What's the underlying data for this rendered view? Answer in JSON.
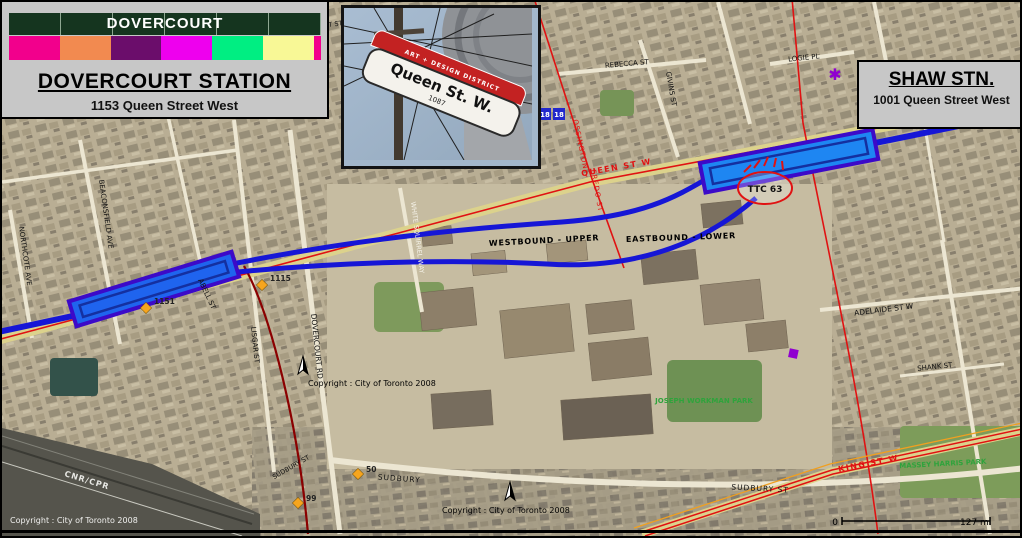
{
  "legend": {
    "title": "DOVERCOURT",
    "colors": [
      "#F2008C",
      "#F28A50",
      "#6B0D6B",
      "#EE00EE",
      "#00EE82",
      "#F8F896"
    ],
    "sliver_color": "#F2008C"
  },
  "panels": {
    "left_station": {
      "title": "DOVERCOURT STATION",
      "subtitle": "1153 Queen Street West"
    },
    "right_station": {
      "title": "SHAW STN.",
      "subtitle": "1001 Queen Street West"
    }
  },
  "inset_photo": {
    "sign_banner": "ART + DESIGN DISTRICT",
    "sign_main": "Queen St. W.",
    "sign_number": "1087"
  },
  "map": {
    "track_labels": [
      {
        "text": "WESTBOUND - UPPER"
      },
      {
        "text": "EASTBOUND - LOWER"
      }
    ],
    "street_labels": [
      {
        "text": "QUEEN ST W"
      },
      {
        "text": "OSSINGTON"
      },
      {
        "text": "FREDO ST"
      },
      {
        "text": "KING ST W"
      },
      {
        "text": "DOVERCOURT RD"
      },
      {
        "text": "LISGAR ST"
      },
      {
        "text": "BEACONSFIELD AVE"
      },
      {
        "text": "NORTHCOTE AVE"
      },
      {
        "text": "ABELL ST"
      },
      {
        "text": "WHITE SQUIRREL WAY"
      },
      {
        "text": "REBECCA ST"
      },
      {
        "text": "GIVINS ST"
      },
      {
        "text": "LOGIE PL"
      },
      {
        "text": "ADELAIDE ST W"
      },
      {
        "text": "SHANK ST"
      },
      {
        "text": "SUDBURY"
      },
      {
        "text": "SUDBURY ST"
      },
      {
        "text": "SUDBURY ST"
      },
      {
        "text": "HUMBERT ST"
      }
    ],
    "park_labels": [
      {
        "text": "JOSEPH WORKMAN PARK"
      },
      {
        "text": "MASSEY HARRIS PARK"
      }
    ],
    "markers": [
      {
        "label": "1151"
      },
      {
        "label": "1115"
      },
      {
        "label": "50"
      },
      {
        "label": "99"
      }
    ],
    "route_badges": [
      {
        "label": "18"
      },
      {
        "label": "18"
      }
    ],
    "ttc_badge": "TTC 63",
    "rail_label": "CNR/CPR",
    "copyright": "Copyright : City of Toronto 2008",
    "scale": {
      "start": "0",
      "end": "127 m"
    }
  },
  "colors": {
    "subway_line_blue": "#1616D6",
    "station_fill_blue": "#1E86F2",
    "station_border_purple": "#3C0AC8",
    "route_red": "#E01212",
    "rail_spur_dark_red": "#8B0000",
    "park_green": "#2FA33C",
    "marker_orange": "#F6A51E",
    "badge_blue": "#2228CC",
    "poi_purple": "#9000D0",
    "queen_road_khaki": "#DCD28C"
  }
}
